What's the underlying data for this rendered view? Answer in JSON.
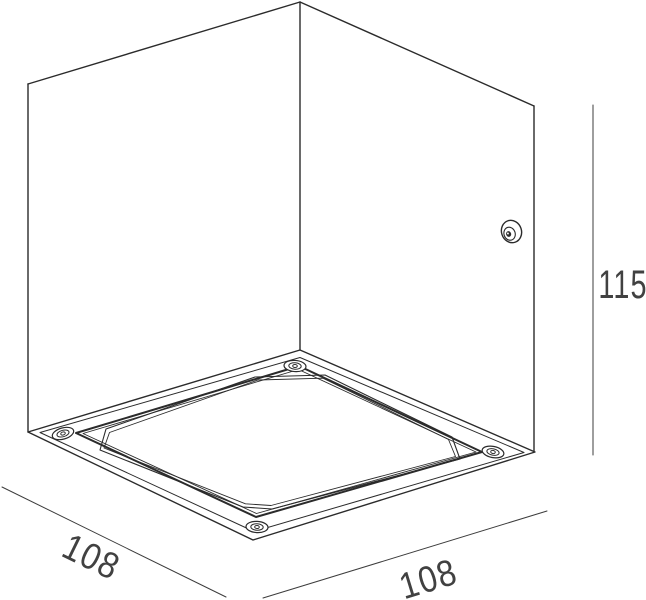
{
  "diagram": {
    "subject": "cube-luminaire-dimension-drawing",
    "dimensions": {
      "width_label": "108",
      "depth_label": "108",
      "height_label": "115"
    },
    "colors": {
      "line": "#2b2b2b",
      "dimension_line": "#3c3c3c",
      "text": "#414141",
      "background": "#ffffff"
    }
  }
}
